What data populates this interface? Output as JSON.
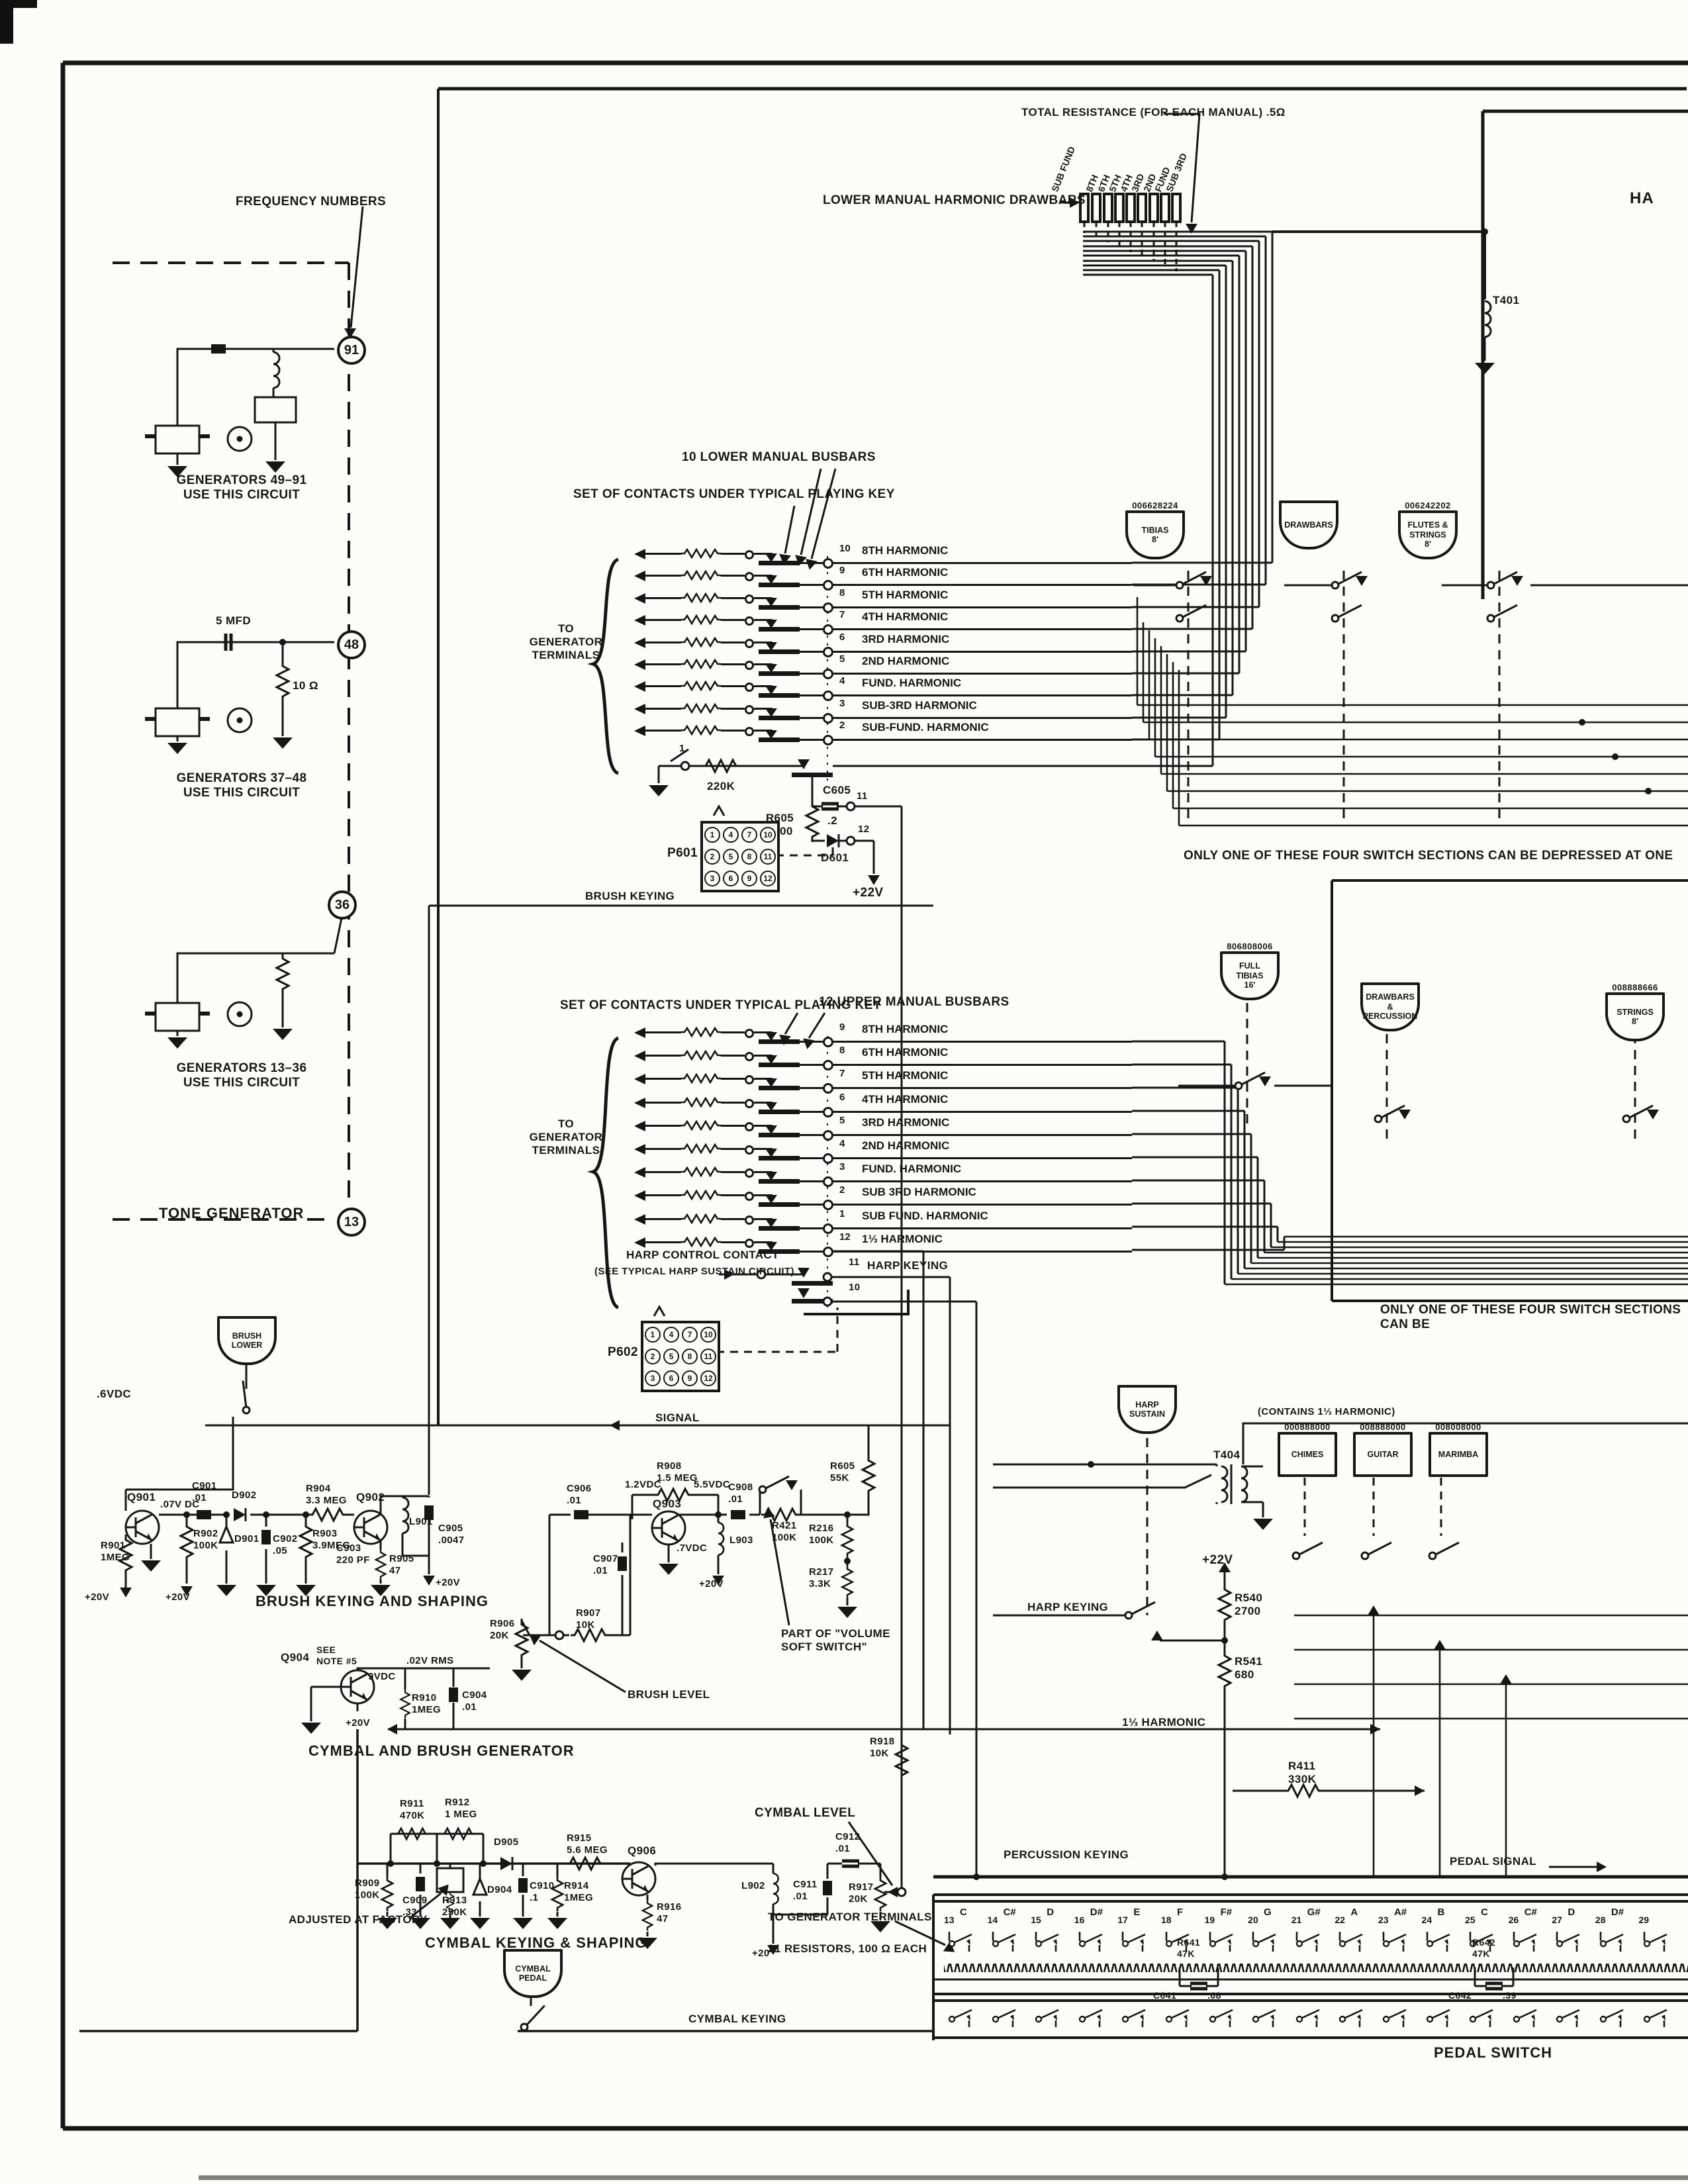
{
  "labels": {
    "total_resistance": "TOTAL RESISTANCE (FOR EACH MANUAL) .5Ω",
    "lower_drawbars": "LOWER MANUAL HARMONIC DRAWBARS",
    "t401": "T401",
    "ha_fragment": "HA",
    "frequency_numbers": "FREQUENCY NUMBERS",
    "gen1": "GENERATORS 49–91\nUSE THIS CIRCUIT",
    "gen2": "GENERATORS 37–48\nUSE THIS CIRCUIT",
    "gen3": "GENERATORS 13–36\nUSE THIS CIRCUIT",
    "mfd5": "5 MFD",
    "r10ohm": "10 Ω",
    "tone_generator": "TONE GENERATOR",
    "c91": "91",
    "c48": "48",
    "c36": "36",
    "c13": "13",
    "lm_busbars": "10 LOWER MANUAL BUSBARS",
    "set_of_contacts": "SET OF CONTACTS UNDER TYPICAL PLAYING KEY",
    "to_gen_terms": "TO\nGENERATOR\nTERMINALS",
    "um_busbars": "12 UPPER MANUAL BUSBARS",
    "r220k": "220K",
    "term1": "1",
    "r605a": "R605\n3300",
    "c605": "C605",
    "c605v": ".2",
    "d601": "D601",
    "term11": "11",
    "term12": "12",
    "v22a": "+22V",
    "p601": "P601",
    "p602": "P602",
    "brush_keying": "BRUSH KEYING",
    "harp_contact": "HARP CONTROL CONTACT",
    "harp_contact_note": "(SEE TYPICAL HARP SUSTAIN CIRCUIT)",
    "term11u": "11",
    "harp_keying_row": "HARP KEYING",
    "term10u": "10",
    "only_one_1": "ONLY ONE OF THESE FOUR SWITCH SECTIONS CAN BE DEPRESSED AT ONE",
    "only_one_2": "ONLY ONE OF THESE FOUR SWITCH SECTIONS CAN BE",
    "harp_sustain": "HARP\nSUSTAIN",
    "contains_13": "(CONTAINS 1⅓ HARMONIC)",
    "t404": "T404",
    "v22b": "+22V",
    "r540": "R540\n2700",
    "r541": "R541\n680",
    "harp_keying": "HARP KEYING",
    "harmonic13": "1⅓ HARMONIC",
    "r411": "R411\n330K",
    "percussion_keying": "PERCUSSION KEYING",
    "brush_lower": "BRUSH\nLOWER",
    "vdc6": ".6VDC",
    "signal": "SIGNAL",
    "q901": "Q901",
    "vdc07": ".07V DC",
    "c901": "C901\n.01",
    "d902": "D902",
    "r901": "R901\n1MEG",
    "r902": "R902\n100K",
    "d901": "D901",
    "c902": "C902\n.05",
    "r903": "R903\n3.9MEG",
    "r904": "R904\n3.3 MEG",
    "q902": "Q902",
    "c903": "C903\n220 PF",
    "r905": "R905\n47",
    "l901": "L901",
    "c905": "C905\n.0047",
    "p20a": "+20V",
    "p20b": "+20V",
    "p20c": "+20V",
    "p20d": "+20V",
    "p20e": "+20V",
    "p20f": "+20",
    "brush_keying_shaping": "BRUSH KEYING AND SHAPING",
    "q904": "Q904",
    "see_note": "SEE\nNOTE #5",
    "rms02": ".02V RMS",
    "vdc9": "9VDC",
    "r910": "R910\n1MEG",
    "c904": "C904\n.01",
    "cymbal_brush_gen": "CYMBAL AND BRUSH GENERATOR",
    "r906": "R906\n20K",
    "r907": "R907\n10K",
    "brush_level": "BRUSH LEVEL",
    "c906": "C906\n.01",
    "vdc12": "1.2VDC",
    "r908": "R908\n1.5 MEG",
    "vdc55": "5.5VDC",
    "q903": "Q903",
    "vdc7": ".7VDC",
    "c907": "C907\n.01",
    "c908": "C908\n.01",
    "l903": "L903",
    "r421": "R421\n100K",
    "r605b": "R605\n55K",
    "r216": "R216\n100K",
    "r217": "R217\n3.3K",
    "volume_soft": "PART OF \"VOLUME\nSOFT SWITCH\"",
    "r911": "R911\n470K",
    "r912": "R912\n1 MEG",
    "r909": "R909\n100K",
    "c909": "C909\n.33",
    "r913": "R913\n250K",
    "d904": "D904",
    "d905": "D905",
    "c910": "C910\n.1",
    "r914": "R914\n1MEG",
    "r915": "R915\n5.6 MEG",
    "q906": "Q906",
    "r916": "R916\n47",
    "l902": "L902",
    "c911": "C911\n.01",
    "c912": "C912\n.01",
    "r917": "R917\n20K",
    "r918": "R918\n10K",
    "cymbal_level": "CYMBAL LEVEL",
    "cymbal_keying_shaping": "CYMBAL KEYING & SHAPING",
    "adjusted": "ADJUSTED AT FACTORY",
    "cymbal_pedal": "CYMBAL\nPEDAL",
    "cymbal_keying": "CYMBAL KEYING",
    "pedal_signal": "PEDAL SIGNAL",
    "to_gen_terms2": "TO GENERATOR TERMINALS",
    "resistors21": "21 RESISTORS, 100 Ω EACH",
    "pedal_switch": "PEDAL SWITCH",
    "r641": "R641\n47K",
    "c641": "C641",
    "c641v": ".68",
    "r642": "R642\n47K",
    "c642": "C642",
    "c642v": ".39"
  },
  "lists": {
    "drawbars": [
      "8TH",
      "6TH",
      "5TH",
      "4TH",
      "3RD",
      "2ND",
      "FUND",
      "SUB 3RD",
      "SUB FUND"
    ],
    "lower_rows": [
      {
        "n": "10",
        "h": "8TH HARMONIC"
      },
      {
        "n": "9",
        "h": "6TH HARMONIC"
      },
      {
        "n": "8",
        "h": "5TH HARMONIC"
      },
      {
        "n": "7",
        "h": "4TH HARMONIC"
      },
      {
        "n": "6",
        "h": "3RD HARMONIC"
      },
      {
        "n": "5",
        "h": "2ND HARMONIC"
      },
      {
        "n": "4",
        "h": "FUND. HARMONIC"
      },
      {
        "n": "3",
        "h": "SUB-3RD HARMONIC"
      },
      {
        "n": "2",
        "h": "SUB-FUND. HARMONIC"
      }
    ],
    "upper_rows": [
      {
        "n": "9",
        "h": "8TH HARMONIC"
      },
      {
        "n": "8",
        "h": "6TH HARMONIC"
      },
      {
        "n": "7",
        "h": "5TH HARMONIC"
      },
      {
        "n": "6",
        "h": "4TH HARMONIC"
      },
      {
        "n": "5",
        "h": "3RD HARMONIC"
      },
      {
        "n": "4",
        "h": "2ND HARMONIC"
      },
      {
        "n": "3",
        "h": "FUND. HARMONIC"
      },
      {
        "n": "2",
        "h": "SUB 3RD HARMONIC"
      },
      {
        "n": "1",
        "h": "SUB FUND. HARMONIC"
      },
      {
        "n": "12",
        "h": "1⅓ HARMONIC"
      }
    ],
    "p_pins": [
      "1",
      "4",
      "7",
      "10",
      "2",
      "5",
      "8",
      "11",
      "3",
      "6",
      "9",
      "12"
    ],
    "tabs1": [
      {
        "num": "",
        "name": "DRAWBARS"
      },
      {
        "num": "006242202",
        "name": "FLUTES &\nSTRINGS\n8'"
      },
      {
        "num": "006628224",
        "name": "TIBIAS\n8'"
      }
    ],
    "tabs2": [
      {
        "num": "",
        "name": "DRAWBARS\n&\nPERCUSSION"
      },
      {
        "num": "008888666",
        "name": "STRINGS\n8'"
      },
      {
        "num": "806808006",
        "name": "FULL\nTIBIAS\n16'"
      }
    ],
    "perc_tabs": [
      {
        "num": "000888000",
        "name": "CHIMES"
      },
      {
        "num": "008888000",
        "name": "GUITAR"
      },
      {
        "num": "008008000",
        "name": "MARIMBA"
      }
    ],
    "pedal_notes": [
      {
        "num": "13",
        "note": "C"
      },
      {
        "num": "14",
        "note": "C#"
      },
      {
        "num": "15",
        "note": "D"
      },
      {
        "num": "16",
        "note": "D#"
      },
      {
        "num": "17",
        "note": "E"
      },
      {
        "num": "18",
        "note": "F"
      },
      {
        "num": "19",
        "note": "F#"
      },
      {
        "num": "20",
        "note": "G"
      },
      {
        "num": "21",
        "note": "G#"
      },
      {
        "num": "22",
        "note": "A"
      },
      {
        "num": "23",
        "note": "A#"
      },
      {
        "num": "24",
        "note": "B"
      },
      {
        "num": "25",
        "note": "C"
      },
      {
        "num": "26",
        "note": "C#"
      },
      {
        "num": "27",
        "note": "D"
      },
      {
        "num": "28",
        "note": "D#"
      },
      {
        "num": "29",
        "note": ""
      }
    ]
  }
}
